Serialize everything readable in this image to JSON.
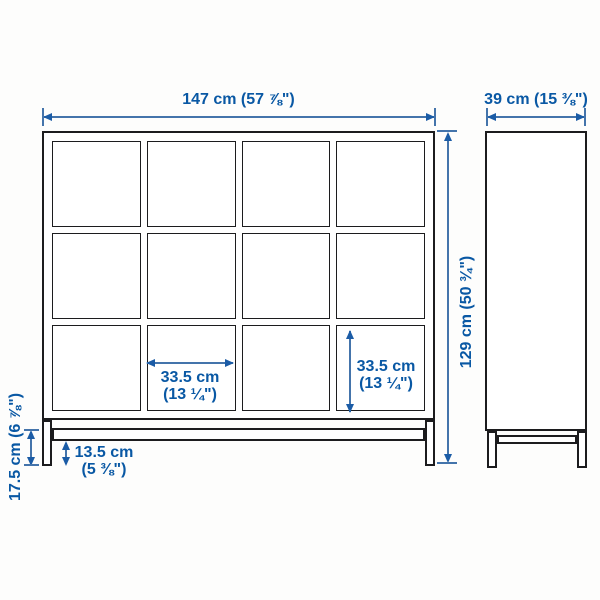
{
  "diagram": {
    "description": "cube shelving unit with underframe, front and side elevation with measurements",
    "colors": {
      "dimension_blue": "#0958a4",
      "furniture_line": "#1c1c1e",
      "background": "#fdfdfc"
    },
    "labels": {
      "width": "147 cm (57 ⅞\")",
      "depth": "39 cm (15 ⅜\")",
      "height": "129 cm (50 ¾\")",
      "cell_width": [
        "33.5 cm",
        "(13 ¼\")"
      ],
      "cell_height": [
        "33.5 cm",
        "(13 ¼\")"
      ],
      "base_clearance": [
        "13.5 cm",
        "(5 ⅜\")"
      ],
      "base_height": "17.5 cm (6 ⅞\")"
    },
    "structure": {
      "front_columns": 4,
      "front_rows": 3,
      "views": [
        "front",
        "side"
      ]
    }
  }
}
